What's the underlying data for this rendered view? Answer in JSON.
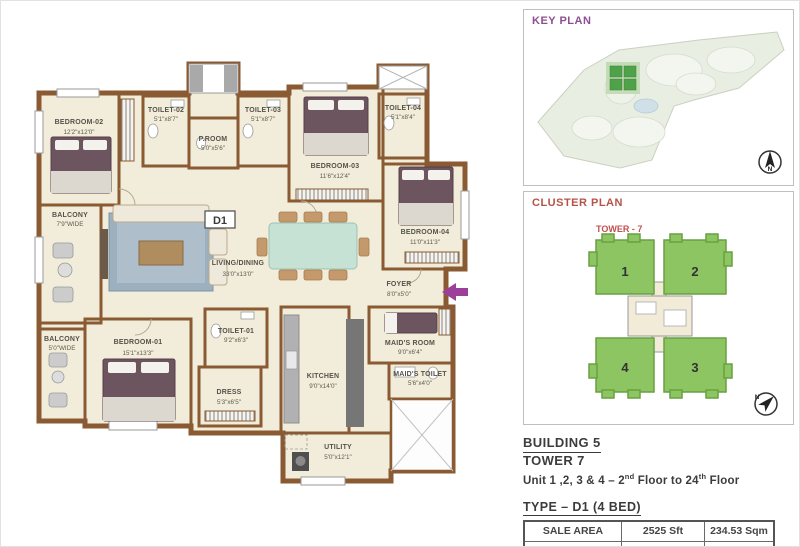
{
  "floorplan": {
    "unit_label": "D1",
    "rooms": {
      "bedroom02": {
        "name": "BEDROOM-02",
        "dims": "12'2\"x12'0\""
      },
      "toilet02": {
        "name": "TOILET-02",
        "dims": "5'1\"x8'7\""
      },
      "proom": {
        "name": "P.ROOM",
        "dims": "5'0\"x5'6\""
      },
      "toilet03": {
        "name": "TOILET-03",
        "dims": "5'1\"x8'7\""
      },
      "bedroom03": {
        "name": "BEDROOM-03",
        "dims": "11'6\"x12'4\""
      },
      "toilet04": {
        "name": "TOILET-04",
        "dims": "5'1\"x8'4\""
      },
      "bedroom04": {
        "name": "BEDROOM-04",
        "dims": "11'0\"x11'3\""
      },
      "balcony1": {
        "name": "BALCONY",
        "dims": "7'9\"WIDE"
      },
      "living": {
        "name": "LIVING/DINING",
        "dims": "33'0\"x13'0\""
      },
      "foyer": {
        "name": "FOYER",
        "dims": "8'0\"x5'0\""
      },
      "balcony2": {
        "name": "BALCONY",
        "dims": "5'0\"WIDE"
      },
      "bedroom01": {
        "name": "BEDROOM-01",
        "dims": "15'1\"x13'3\""
      },
      "toilet01": {
        "name": "TOILET-01",
        "dims": "9'2\"x6'3\""
      },
      "dress": {
        "name": "DRESS",
        "dims": "5'3\"x6'5\""
      },
      "kitchen": {
        "name": "KITCHEN",
        "dims": "9'0\"x14'0\""
      },
      "maidsroom": {
        "name": "MAID'S ROOM",
        "dims": "9'0\"x6'4\""
      },
      "maidstoilet": {
        "name": "MAID'S TOILET",
        "dims": "5'6\"x4'0\""
      },
      "utility": {
        "name": "UTILITY",
        "dims": "5'0\"x12'1\""
      }
    }
  },
  "key_plan": {
    "title": "KEY PLAN",
    "north_label": "N"
  },
  "cluster_plan": {
    "title": "CLUSTER PLAN",
    "tower_label": "TOWER - 7",
    "units": [
      "1",
      "2",
      "4",
      "3"
    ],
    "north_label": "N"
  },
  "info": {
    "building": "BUILDING 5",
    "tower": "TOWER  7",
    "units_line": {
      "p1": "Unit 1 ,2, 3 & 4 – 2",
      "sup1": "nd",
      "p2": " Floor to 24",
      "sup2": "th",
      "p3": " Floor"
    },
    "type": "TYPE – D1 (4 BED)",
    "table": {
      "rows": [
        {
          "label": "SALE AREA",
          "sft": "2525 Sft",
          "sqm": "234.53 Sqm"
        },
        {
          "label": "CARPET AREA",
          "sft": "1740 Sft",
          "sqm": "161.67 Sqm"
        }
      ]
    }
  },
  "colors": {
    "wall_brown": "#8a5a33",
    "floor_cream": "#f2edda",
    "keyplan_title": "#8d4f92",
    "clusterplan_title": "#b5524a",
    "cluster_block_green": "#8cc561",
    "entry_arrow_purple": "#9b3f9b",
    "dining_table_teal": "#c5e2d4"
  }
}
